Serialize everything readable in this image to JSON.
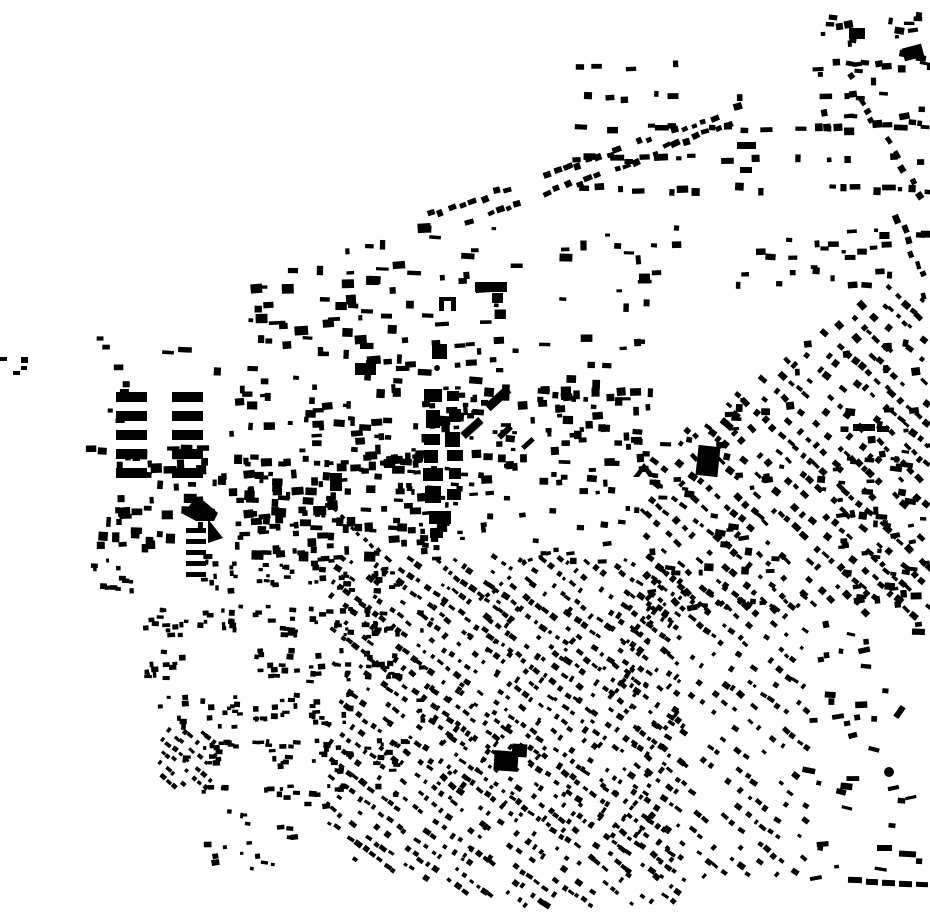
{
  "map": {
    "title_semantic": "figure-ground building footprint map",
    "background": "#ffffff",
    "ink": "#000000",
    "width": 930,
    "height": 924,
    "seed": 1337,
    "districts": [
      {
        "id": "topright-rows",
        "type": "rows",
        "bbox": [
          565,
          58,
          358,
          158
        ],
        "rowSpacing": 31,
        "colSpacing": 16,
        "skip": 0.5,
        "bw": [
          4,
          14
        ],
        "bh": [
          4,
          8
        ],
        "jitter": 8
      },
      {
        "id": "topright-corner",
        "type": "scatter",
        "bbox": [
          820,
          12,
          108,
          120
        ],
        "count": 40,
        "bw": [
          4,
          11
        ],
        "bh": [
          3,
          8
        ],
        "jitter": 25
      },
      {
        "id": "right-edge-strings",
        "type": "strings",
        "segments": [
          [
            [
              848,
              78
            ],
            [
              930,
              212
            ]
          ],
          [
            [
              900,
              218
            ],
            [
              928,
              298
            ]
          ]
        ],
        "spacing": 13,
        "bw": [
          5,
          9
        ],
        "bh": [
          4,
          7
        ],
        "perpJitter": 4,
        "skip": 0.2,
        "jitter": 10
      },
      {
        "id": "top-diagonal-band",
        "type": "strings",
        "segments": [
          [
            [
              432,
              215
            ],
            [
              744,
              106
            ]
          ],
          [
            [
              470,
              224
            ],
            [
              740,
              120
            ]
          ]
        ],
        "spacing": 11,
        "bw": [
          5,
          10
        ],
        "bh": [
          4,
          7
        ],
        "perpJitter": 3,
        "skip": 0.25,
        "jitter": 12
      },
      {
        "id": "north-central",
        "type": "scatter",
        "bbox": [
          148,
          228,
          505,
          165
        ],
        "count": 150,
        "bw": [
          4,
          14
        ],
        "bh": [
          3,
          10
        ],
        "jitter": 10,
        "clips": [
          [
            0.42,
            1,
            393
          ]
        ]
      },
      {
        "id": "apartment-grid",
        "type": "grid",
        "origin": [
          116,
          392
        ],
        "cols": 2,
        "rows": 5,
        "cellW": 56,
        "cellH": 19,
        "barW": 31,
        "barH": 10
      },
      {
        "id": "apartment-grid-small",
        "type": "grid",
        "origin": [
          186,
          528
        ],
        "cols": 1,
        "rows": 5,
        "cellW": 24,
        "cellH": 11,
        "barW": 20,
        "barH": 5
      },
      {
        "id": "left-edge-mid",
        "type": "scatter",
        "bbox": [
          95,
          338,
          58,
          100
        ],
        "count": 7,
        "bw": [
          5,
          10
        ],
        "bh": [
          4,
          7
        ],
        "jitter": 0
      },
      {
        "id": "central-west",
        "type": "scatter",
        "bbox": [
          228,
          392,
          235,
          168
        ],
        "count": 120,
        "bw": [
          4,
          12
        ],
        "bh": [
          3,
          9
        ],
        "jitter": 12
      },
      {
        "id": "central-east",
        "type": "scatter",
        "bbox": [
          463,
          390,
          195,
          96
        ],
        "count": 80,
        "bw": [
          4,
          12
        ],
        "bh": [
          3,
          9
        ],
        "jitter": 12
      },
      {
        "id": "park-sparse",
        "type": "scatter",
        "bbox": [
          560,
          468,
          100,
          95
        ],
        "count": 16,
        "bw": [
          4,
          9
        ],
        "bh": [
          3,
          7
        ],
        "jitter": 15
      },
      {
        "id": "park-west",
        "type": "scatter",
        "bbox": [
          432,
          490,
          128,
          68
        ],
        "count": 13,
        "bw": [
          4,
          9
        ],
        "bh": [
          3,
          6
        ],
        "jitter": 15
      },
      {
        "id": "park-arc-dots",
        "type": "strings",
        "segments": [
          [
            [
              482,
              600
            ],
            [
              524,
              562
            ]
          ],
          [
            [
              524,
              562
            ],
            [
              548,
              552
            ]
          ],
          [
            [
              330,
              505
            ],
            [
              378,
              552
            ]
          ]
        ],
        "spacing": 9,
        "bw": [
          4,
          5
        ],
        "bh": [
          3,
          4
        ],
        "perpJitter": 2,
        "skip": 0.1,
        "jitter": 10
      },
      {
        "id": "mid-left-band",
        "type": "scatter",
        "bbox": [
          88,
          446,
          335,
          112
        ],
        "count": 130,
        "bw": [
          4,
          13
        ],
        "bh": [
          4,
          10
        ],
        "jitter": 8
      },
      {
        "id": "campus-extra",
        "type": "scatter",
        "bbox": [
          408,
          385,
          70,
          155
        ],
        "count": 25,
        "bw": [
          3,
          8
        ],
        "bh": [
          3,
          7
        ],
        "jitter": 10
      },
      {
        "id": "bottomleft-blocks",
        "type": "blocks",
        "bbox": [
          88,
          558,
          335,
          240
        ],
        "blockW": 46,
        "blockH": 36,
        "gap": 9,
        "perBlock": 13,
        "blockSkip": 0.07,
        "bw": [
          3,
          8
        ],
        "bh": [
          3,
          6
        ],
        "jitter": 10,
        "clips": [
          [
            1,
            -0.45,
            -162
          ]
        ]
      },
      {
        "id": "bottomleft-diag-cluster",
        "type": "hatch",
        "bbox": [
          158,
          728,
          58,
          62
        ],
        "angle": 40,
        "lineSpacing": 10,
        "spacing": 8,
        "skip": 0.3,
        "bw": [
          3,
          7
        ],
        "bh": [
          3,
          5
        ],
        "jitter": 8
      },
      {
        "id": "bottomleft-trail",
        "type": "scatter",
        "bbox": [
          200,
          792,
          150,
          78
        ],
        "count": 20,
        "bw": [
          3,
          8
        ],
        "bh": [
          3,
          6
        ],
        "jitter": 20
      },
      {
        "id": "bottom-center-hatch",
        "type": "hatch",
        "bbox": [
          328,
          556,
          356,
          352
        ],
        "angle": 37,
        "lineSpacing": 13,
        "spacing": 9,
        "skip": 0.34,
        "bw": [
          3,
          8
        ],
        "bh": [
          3,
          6
        ],
        "jitter": 10,
        "clips": [
          [
            0.28,
            -1,
            -763
          ]
        ]
      },
      {
        "id": "bottom-center-cross",
        "type": "hatch",
        "bbox": [
          430,
          600,
          250,
          260
        ],
        "angle": 127,
        "lineSpacing": 21,
        "spacing": 10,
        "skip": 0.55,
        "bw": [
          3,
          7
        ],
        "bh": [
          3,
          5
        ],
        "jitter": 10,
        "clips": [
          [
            0.28,
            -1,
            -763
          ]
        ]
      },
      {
        "id": "right-diagonal",
        "type": "hatch",
        "bbox": [
          642,
          286,
          288,
          332
        ],
        "angle": 42,
        "lineSpacing": 15,
        "spacing": 10,
        "skip": 0.35,
        "bw": [
          4,
          9
        ],
        "bh": [
          3,
          7
        ],
        "jitter": 12,
        "clips": [
          [
            0.714,
            1,
            919
          ]
        ]
      },
      {
        "id": "right-diagonal-clusters",
        "type": "scatter",
        "bbox": [
          640,
          340,
          290,
          270
        ],
        "count": 90,
        "bw": [
          4,
          11
        ],
        "bh": [
          3,
          8
        ],
        "jitter": 25,
        "clips": [
          [
            0.714,
            1,
            919
          ]
        ]
      },
      {
        "id": "upper-wedge-row",
        "type": "scatter",
        "bbox": [
          650,
          228,
          278,
          58
        ],
        "count": 32,
        "bw": [
          4,
          11
        ],
        "bh": [
          3,
          7
        ],
        "jitter": 10
      },
      {
        "id": "bottom-right-hatch",
        "type": "hatch",
        "bbox": [
          622,
          585,
          186,
          292
        ],
        "angle": 38,
        "lineSpacing": 15,
        "spacing": 10,
        "skip": 0.5,
        "bw": [
          3,
          8
        ],
        "bh": [
          3,
          6
        ],
        "jitter": 12,
        "clips": [
          [
            0,
            -1,
            -878
          ]
        ]
      },
      {
        "id": "far-right-sparse",
        "type": "scatter",
        "bbox": [
          800,
          592,
          128,
          288
        ],
        "count": 40,
        "bw": [
          4,
          13
        ],
        "bh": [
          3,
          7
        ],
        "jitter": 30
      },
      {
        "id": "far-right-upper",
        "type": "scatter",
        "bbox": [
          835,
          450,
          95,
          140
        ],
        "count": 25,
        "bw": [
          4,
          12
        ],
        "bh": [
          3,
          7
        ],
        "jitter": 20
      }
    ],
    "landmarks": {
      "rects": [
        [
          0,
          357,
          7,
          4,
          0
        ],
        [
          13,
          371,
          7,
          4,
          0
        ],
        [
          21,
          357,
          7,
          6,
          0
        ],
        [
          21,
          366,
          6,
          4,
          0
        ],
        [
          424,
          389,
          18,
          13,
          0
        ],
        [
          447,
          391,
          12,
          10,
          0
        ],
        [
          426,
          410,
          14,
          18,
          0
        ],
        [
          449,
          409,
          12,
          13,
          0
        ],
        [
          424,
          434,
          16,
          11,
          0
        ],
        [
          445,
          432,
          15,
          15,
          0
        ],
        [
          424,
          450,
          14,
          13,
          0
        ],
        [
          447,
          450,
          16,
          11,
          0
        ],
        [
          423,
          468,
          20,
          13,
          0
        ],
        [
          449,
          468,
          12,
          11,
          0
        ],
        [
          425,
          486,
          16,
          17,
          0
        ],
        [
          447,
          489,
          14,
          11,
          0
        ],
        [
          429,
          511,
          22,
          13,
          0
        ],
        [
          430,
          529,
          13,
          9,
          0
        ],
        [
          439,
          297,
          5,
          14,
          0
        ],
        [
          451,
          297,
          5,
          14,
          0
        ],
        [
          439,
          297,
          17,
          4,
          0
        ],
        [
          432,
          344,
          15,
          15,
          0
        ],
        [
          475,
          282,
          32,
          10,
          0
        ],
        [
          492,
          293,
          11,
          10,
          0
        ],
        [
          484,
          394,
          28,
          9,
          -42
        ],
        [
          460,
          424,
          24,
          8,
          -42
        ],
        [
          497,
          429,
          16,
          6,
          -42
        ],
        [
          521,
          441,
          14,
          5,
          -42
        ],
        [
          494,
          751,
          24,
          20,
          4
        ],
        [
          512,
          744,
          15,
          13,
          4
        ],
        [
          697,
          446,
          22,
          30,
          6
        ],
        [
          903,
          46,
          20,
          13,
          -15
        ],
        [
          849,
          28,
          16,
          11,
          0
        ],
        [
          737,
          142,
          19,
          7,
          0
        ],
        [
          740,
          167,
          12,
          6,
          0
        ],
        [
          355,
          363,
          21,
          12,
          0
        ],
        [
          853,
          424,
          22,
          7,
          0
        ],
        [
          877,
          426,
          12,
          6,
          0
        ],
        [
          848,
          877,
          14,
          6,
          2
        ],
        [
          866,
          879,
          12,
          6,
          2
        ],
        [
          882,
          880,
          13,
          6,
          2
        ],
        [
          899,
          881,
          13,
          6,
          2
        ],
        [
          916,
          882,
          12,
          5,
          2
        ],
        [
          877,
          845,
          15,
          6,
          0
        ],
        [
          899,
          851,
          17,
          6,
          3
        ],
        [
          893,
          709,
          13,
          6,
          -55
        ],
        [
          330,
          473,
          12,
          18,
          0
        ]
      ],
      "polygons": [
        [
          [
            183,
            514
          ],
          [
            193,
            501
          ],
          [
            204,
            501
          ],
          [
            218,
            513
          ],
          [
            214,
            521
          ],
          [
            196,
            521
          ]
        ],
        [
          [
            208,
            519
          ],
          [
            223,
            538
          ],
          [
            208,
            543
          ]
        ],
        [
          [
            633,
            477
          ],
          [
            644,
            463
          ],
          [
            656,
            477
          ],
          [
            649,
            477
          ],
          [
            644,
            470
          ],
          [
            639,
            477
          ]
        ]
      ],
      "circles": [
        [
          437,
          368,
          3
        ],
        [
          889,
          772,
          5
        ]
      ]
    }
  }
}
